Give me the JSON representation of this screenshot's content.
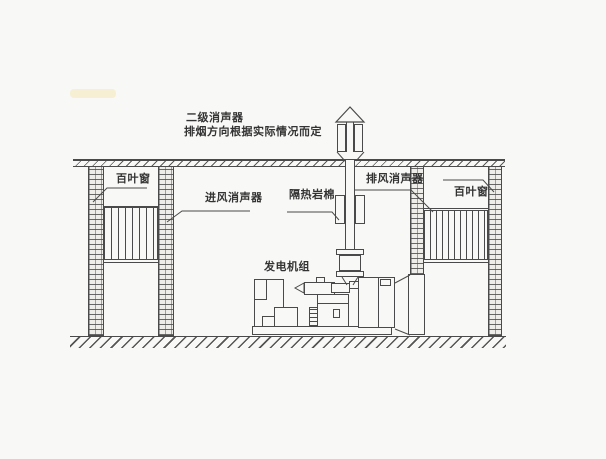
{
  "diagram": {
    "kind": "generator-room-noise-control-section",
    "colors": {
      "line": "#4a4a4a",
      "background": "#f8f8f6",
      "text": "#333333",
      "brick_fill": "#efede9"
    },
    "labels": {
      "secondary_silencer": "二级消声器",
      "smoke_direction_note": "排烟方向根据实际情况而定",
      "louver_window_left": "百叶窗",
      "intake_silencer": "进风消声器",
      "rock_wool": "隔热岩棉",
      "exhaust_silencer": "排风消声器",
      "louver_window_right": "百叶窗",
      "generator_set": "发电机组"
    }
  }
}
